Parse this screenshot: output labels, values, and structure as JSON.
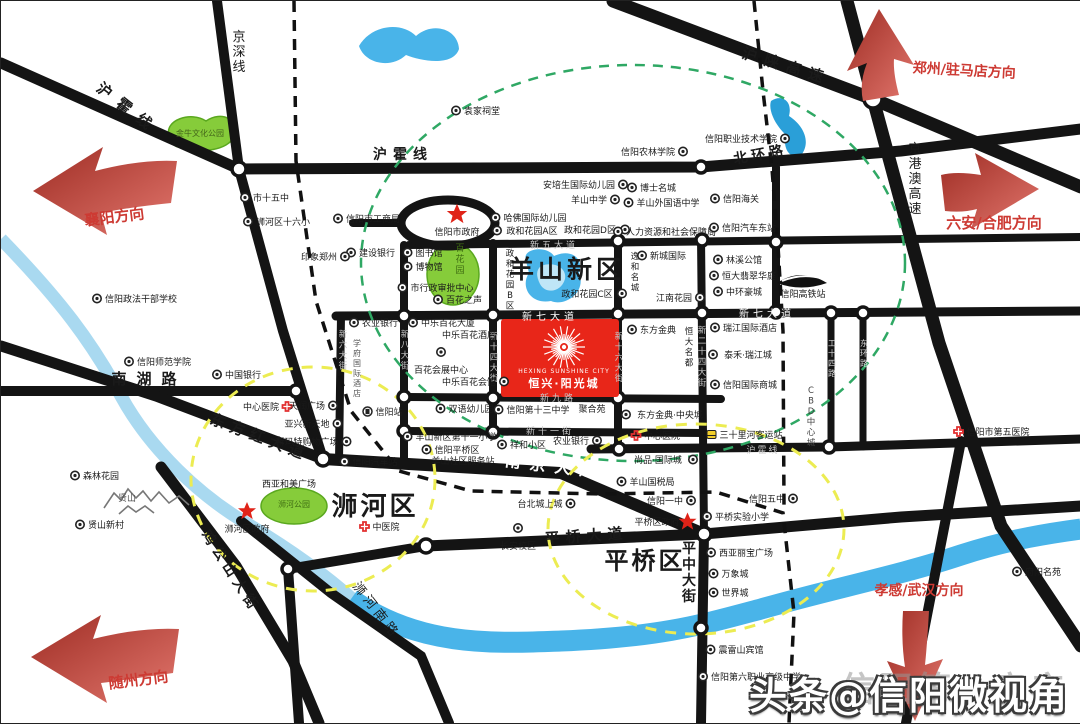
{
  "watermark": {
    "shadow_text": "信阳第一房产",
    "main_text": "头条@信阳微视角"
  },
  "landmark": {
    "en": "HEXING SUNSHINE CITY",
    "cn": "恒兴·阳光城"
  },
  "colors": {
    "road": "#141414",
    "river": "#49b4e9",
    "stream": "#a9d9f0",
    "park": "#86cc3a",
    "landmark_red": "#e82619",
    "direction_red": "#cd3a33",
    "green_ring": "#2fa864",
    "yellow_ring": "#ecec52",
    "star_red": "#e02318",
    "cross_red": "#e23030"
  },
  "labels": [
    {
      "n": "road-huhuo-line-nw",
      "t": "沪霍线",
      "x": 124,
      "y": 112,
      "s": 15,
      "r": 38,
      "ls": 10,
      "b": 1
    },
    {
      "n": "road-jingshen-line",
      "t": "京深线",
      "x": 238,
      "y": 40,
      "s": 13,
      "v": 1
    },
    {
      "n": "road-huhuo-line-n",
      "t": "沪霍线",
      "x": 402,
      "y": 158,
      "s": 14,
      "ls": 6,
      "b": 1
    },
    {
      "n": "road-hushan-expressway",
      "t": "沪陕高速",
      "x": 784,
      "y": 70,
      "s": 15,
      "r": 17,
      "ls": 8,
      "b": 1
    },
    {
      "n": "road-beihuan-road",
      "t": "北环路",
      "x": 760,
      "y": 158,
      "s": 14,
      "r": -10,
      "ls": 4,
      "b": 1
    },
    {
      "n": "road-jinggangao-expressway",
      "t": "京港澳高速",
      "x": 914,
      "y": 152,
      "s": 13,
      "v": 1
    },
    {
      "n": "road-xinwu-avenue",
      "t": "新五大道",
      "x": 553,
      "y": 247,
      "s": 9,
      "c": "#c8c8c8",
      "ls": 3
    },
    {
      "n": "road-xinqi-avenue-west",
      "t": "新七大道",
      "x": 549,
      "y": 319,
      "s": 10,
      "c": "#ffffff",
      "ls": 4
    },
    {
      "n": "road-xinqi-avenue-east",
      "t": "新七大道",
      "x": 766,
      "y": 316,
      "s": 10,
      "c": "#ffffff",
      "ls": 4
    },
    {
      "n": "road-xinjiu-road",
      "t": "新九路",
      "x": 557,
      "y": 400,
      "s": 9,
      "c": "#c8c8c8",
      "ls": 3
    },
    {
      "n": "road-xinshiyi-street",
      "t": "新十一街",
      "x": 549,
      "y": 433,
      "s": 9,
      "c": "#c8c8c8",
      "ls": 3
    },
    {
      "n": "road-nanjing-avenue",
      "t": "南京大道",
      "x": 553,
      "y": 471,
      "s": 16,
      "c": "#ffffff",
      "b": 1,
      "r": 7,
      "ls": 9
    },
    {
      "n": "road-nanhu-road",
      "t": "南湖路",
      "x": 148,
      "y": 383,
      "s": 15,
      "ls": 10,
      "b": 1
    },
    {
      "n": "road-dongfanghong-avenue",
      "t": "东方红大道",
      "x": 257,
      "y": 441,
      "s": 15,
      "r": 21,
      "ls": 6,
      "b": 1
    },
    {
      "n": "road-huhuo-line-east",
      "t": "沪霍线",
      "x": 762,
      "y": 452,
      "s": 9,
      "c": "#c8c8c8",
      "ls": 2
    },
    {
      "n": "road-pingqiao-avenue",
      "t": "平桥大道",
      "x": 586,
      "y": 540,
      "s": 15,
      "r": -4,
      "ls": 6,
      "b": 1
    },
    {
      "n": "road-pingzhong-street",
      "t": "平中大街",
      "x": 688,
      "y": 552,
      "s": 14,
      "v": 1,
      "b": 1
    },
    {
      "n": "road-jigongshan-street",
      "t": "鸡公山大街",
      "x": 226,
      "y": 573,
      "s": 14,
      "r": 57,
      "ls": 5,
      "b": 1
    },
    {
      "n": "road-shihe-south-road",
      "t": "浉河南路",
      "x": 372,
      "y": 612,
      "s": 13,
      "r": 52,
      "ls": 4
    },
    {
      "n": "road-xinliu-street",
      "t": "新六大街",
      "x": 342,
      "y": 336,
      "s": 8.5,
      "v": 1,
      "c": "#c8c8c8"
    },
    {
      "n": "road-xinba-street",
      "t": "新八大街",
      "x": 404,
      "y": 336,
      "s": 8.5,
      "v": 1,
      "c": "#c8c8c8"
    },
    {
      "n": "road-xinshisi-street",
      "t": "新十四大街",
      "x": 493,
      "y": 338,
      "s": 8.5,
      "v": 1,
      "c": "#c8c8c8"
    },
    {
      "n": "road-xinshiliu-street",
      "t": "新十六大街",
      "x": 618,
      "y": 338,
      "s": 8.5,
      "v": 1,
      "c": "#c8c8c8"
    },
    {
      "n": "road-xinershisi-street",
      "t": "新二十四大街",
      "x": 701,
      "y": 332,
      "s": 8.5,
      "v": 1,
      "c": "#c8c8c8"
    },
    {
      "n": "road-gongshisi-road",
      "t": "工十四路",
      "x": 831,
      "y": 345,
      "s": 8,
      "v": 1,
      "c": "#d8d8d8"
    },
    {
      "n": "road-donghuan-road",
      "t": "东环路",
      "x": 863,
      "y": 345,
      "s": 8,
      "v": 1,
      "c": "#d8d8d8"
    },
    {
      "n": "area-cbd-center-city",
      "t": "CBD中心城",
      "x": 810,
      "y": 392,
      "s": 8.5,
      "v": 1,
      "c": "#444444"
    },
    {
      "n": "district-yangshan-new-district",
      "t": "羊山新区",
      "x": 566,
      "y": 277,
      "s": 25,
      "b": 1,
      "ls": 4
    },
    {
      "n": "district-shihe",
      "t": "浉河区",
      "x": 374,
      "y": 514,
      "s": 26,
      "b": 1,
      "ls": 3
    },
    {
      "n": "district-pingqiao",
      "t": "平桥区",
      "x": 644,
      "y": 568,
      "s": 24,
      "b": 1,
      "ls": 3
    },
    {
      "n": "direction-zhengzhou-zhumadian",
      "t": "郑州/驻马店方向",
      "x": 963,
      "y": 74,
      "s": 14,
      "b": 1,
      "c": "#cd3a33",
      "r": 3
    },
    {
      "n": "direction-luan-hefei",
      "t": "六安/合肥方向",
      "x": 993,
      "y": 227,
      "s": 15,
      "b": 1,
      "c": "#cd3a33"
    },
    {
      "n": "direction-xiangyang",
      "t": "襄阳方向",
      "x": 114,
      "y": 221,
      "s": 15,
      "b": 1,
      "c": "#cd3a33",
      "r": -7
    },
    {
      "n": "direction-suizhou",
      "t": "随州方向",
      "x": 138,
      "y": 684,
      "s": 15,
      "b": 1,
      "c": "#cd3a33",
      "r": -7
    },
    {
      "n": "direction-xiaogan-wuhan",
      "t": "孝感/武汉方向",
      "x": 918,
      "y": 594,
      "s": 14,
      "b": 1,
      "c": "#cd3a33"
    },
    {
      "n": "poi-jinniu-culture-park",
      "t": "金牛文化公园",
      "x": 199,
      "y": 135,
      "s": 8,
      "c": "#44661a"
    },
    {
      "n": "poi-no15-middle-school",
      "t": "市十五中",
      "x": 270,
      "y": 200,
      "icon": "ring",
      "ip": "l"
    },
    {
      "n": "poi-shihe-no16-primary",
      "t": "浉河区十六小",
      "x": 282,
      "y": 224,
      "icon": "ring",
      "ip": "l"
    },
    {
      "n": "poi-industry-commerce-bureau",
      "t": "信阳市工商局",
      "x": 372,
      "y": 221,
      "icon": "ring",
      "ip": "l"
    },
    {
      "n": "poi-yuanjia-ancestral-hall",
      "t": "袁家祠堂",
      "x": 481,
      "y": 113,
      "icon": "ring",
      "ip": "l"
    },
    {
      "n": "poi-xinyang-city-government",
      "t": "信阳市政府",
      "x": 456,
      "y": 234,
      "icon": "star",
      "ip": "t",
      "isc": 1.7
    },
    {
      "n": "poi-harvard-kindergarten",
      "t": "哈佛国际幼儿园",
      "x": 534,
      "y": 220,
      "icon": "ring",
      "ip": "l"
    },
    {
      "n": "poi-zhenghe-garden-a",
      "t": "政和花园A区",
      "x": 531,
      "y": 233,
      "icon": "ring",
      "ip": "l"
    },
    {
      "n": "poi-zhenghe-garden-d",
      "t": "政和花园D区",
      "x": 589,
      "y": 232,
      "icon": "ring",
      "ip": "r"
    },
    {
      "n": "poi-anpeisheng-kindergarten",
      "t": "安培生国际幼儿园",
      "x": 578,
      "y": 187,
      "icon": "ring",
      "ip": "r"
    },
    {
      "n": "poi-yangshan-middle-school",
      "t": "羊山中学",
      "x": 588,
      "y": 202,
      "icon": "ring",
      "ip": "r"
    },
    {
      "n": "poi-agriculture-forestry-college",
      "t": "信阳农林学院",
      "x": 647,
      "y": 154,
      "icon": "ring",
      "ip": "r"
    },
    {
      "n": "poi-boshi-mingcheng",
      "t": "博士名城",
      "x": 657,
      "y": 190,
      "icon": "ring",
      "ip": "l"
    },
    {
      "n": "poi-yangshan-foreign-language-school",
      "t": "羊山外国语中学",
      "x": 667,
      "y": 205,
      "icon": "ring",
      "ip": "l"
    },
    {
      "n": "poi-human-resources-bureau",
      "t": "人力资源和社会保障局",
      "x": 670,
      "y": 234,
      "icon": "ring",
      "ip": "l"
    },
    {
      "n": "poi-vocational-technical-college",
      "t": "信阳职业技术学院",
      "x": 740,
      "y": 141,
      "icon": "ring",
      "ip": "r"
    },
    {
      "n": "poi-xinyang-customs",
      "t": "信阳海关",
      "x": 740,
      "y": 201,
      "icon": "ring",
      "ip": "l"
    },
    {
      "n": "poi-east-bus-station",
      "t": "信阳汽车东站",
      "x": 748,
      "y": 230,
      "icon": "ring",
      "ip": "l"
    },
    {
      "n": "poi-construction-bank",
      "t": "建设银行",
      "x": 376,
      "y": 255,
      "icon": "ring",
      "ip": "l"
    },
    {
      "n": "poi-library",
      "t": "图书馆",
      "x": 428,
      "y": 255,
      "icon": "ring",
      "ip": "l"
    },
    {
      "n": "poi-museum",
      "t": "博物馆",
      "x": 428,
      "y": 269,
      "icon": "ring",
      "ip": "l"
    },
    {
      "n": "poi-baihua-garden",
      "t": "百花园",
      "x": 459,
      "y": 250,
      "s": 9,
      "v": 1,
      "c": "#3f6d12"
    },
    {
      "n": "poi-administrative-approval-center",
      "t": "市行政审批中心",
      "x": 441,
      "y": 290,
      "icon": "ring",
      "ip": "l"
    },
    {
      "n": "poi-baihua-zhisheng",
      "t": "百花之声",
      "x": 463,
      "y": 302,
      "icon": "ring",
      "ip": "l"
    },
    {
      "n": "poi-zhenghe-garden-b",
      "t": "政和花园B区",
      "x": 509,
      "y": 255,
      "s": 8.5,
      "v": 1
    },
    {
      "n": "poi-zhenghe-garden-c",
      "t": "政和花园C区",
      "x": 586,
      "y": 296,
      "icon": "ring",
      "ip": "r"
    },
    {
      "n": "poi-xincheng-international",
      "t": "新城国际",
      "x": 667,
      "y": 258,
      "icon": "ring",
      "ip": "l"
    },
    {
      "n": "poi-yihe-mingcheng",
      "t": "逸和名城",
      "x": 634,
      "y": 258,
      "s": 8.5,
      "v": 1
    },
    {
      "n": "poi-jiangnan-garden",
      "t": "江南花园",
      "x": 673,
      "y": 300,
      "icon": "ring",
      "ip": "r"
    },
    {
      "n": "poi-linxi-mansion",
      "t": "林溪公馆",
      "x": 743,
      "y": 262,
      "icon": "ring",
      "ip": "l"
    },
    {
      "n": "poi-hengda-feicui-huating",
      "t": "恒大翡翠华庭",
      "x": 748,
      "y": 278,
      "icon": "ring",
      "ip": "l"
    },
    {
      "n": "poi-zhonghuan-haocheng",
      "t": "中环豪城",
      "x": 743,
      "y": 294,
      "icon": "ring",
      "ip": "l"
    },
    {
      "n": "poi-xinyang-hsr-station",
      "t": "信阳高铁站",
      "x": 802,
      "y": 296
    },
    {
      "n": "poi-agricultural-bank-west",
      "t": "农业银行",
      "x": 379,
      "y": 325,
      "icon": "ring",
      "ip": "l"
    },
    {
      "n": "poi-zhongle-baihua-tower",
      "t": "中乐百花大厦",
      "x": 447,
      "y": 325,
      "icon": "ring",
      "ip": "l"
    },
    {
      "n": "poi-zhongle-baihua-hotel",
      "t": "中乐百花酒店",
      "x": 468,
      "y": 337
    },
    {
      "n": "poi-baihua-exhibition-center",
      "t": "百花会展中心",
      "x": 440,
      "y": 372,
      "icon": "ring",
      "ip": "t"
    },
    {
      "n": "poi-zhongle-baihua-club",
      "t": "中乐百花会馆",
      "x": 468,
      "y": 384,
      "icon": "ring",
      "ip": "r"
    },
    {
      "n": "poi-xuefu-international-hotel",
      "t": "学府国际酒店",
      "x": 356,
      "y": 345,
      "s": 8,
      "v": 1,
      "c": "#555555"
    },
    {
      "n": "poi-dongfang-jindian",
      "t": "东方金典",
      "x": 657,
      "y": 332,
      "icon": "ring",
      "ip": "l"
    },
    {
      "n": "poi-hengda-mingdu",
      "t": "恒大名都",
      "x": 688,
      "y": 333,
      "s": 8.5,
      "v": 1
    },
    {
      "n": "poi-ruijiang-international-hotel",
      "t": "瑞江国际酒店",
      "x": 749,
      "y": 330,
      "icon": "ring",
      "ip": "l"
    },
    {
      "n": "poi-taihe-ruijiang-city",
      "t": "泰禾·瑞江城",
      "x": 747,
      "y": 357,
      "icon": "ring",
      "ip": "l"
    },
    {
      "n": "poi-xinyang-international-mall",
      "t": "信阳国际商城",
      "x": 749,
      "y": 387,
      "icon": "ring",
      "ip": "l"
    },
    {
      "n": "poi-dongfang-jindian-central-city",
      "t": "东方金典·中央城",
      "x": 669,
      "y": 417,
      "icon": "ring",
      "ip": "l"
    },
    {
      "n": "poi-central-hospital-east",
      "t": "中心医院",
      "x": 661,
      "y": 438,
      "icon": "cross",
      "ip": "l"
    },
    {
      "n": "poi-central-hospital-west",
      "t": "中心医院",
      "x": 260,
      "y": 409,
      "icon": "cross",
      "ip": "r"
    },
    {
      "n": "poi-tianrun-plaza",
      "t": "天润广场",
      "x": 306,
      "y": 408,
      "icon": "ring",
      "ip": "r"
    },
    {
      "n": "poi-yaxing-new-world",
      "t": "亚兴新天地",
      "x": 306,
      "y": 426,
      "icon": "ring",
      "ip": "r"
    },
    {
      "n": "poi-xinmate-shopping-plaza",
      "t": "新玛特购物广场",
      "x": 306,
      "y": 444,
      "icon": "ring",
      "ip": "r"
    },
    {
      "n": "poi-yinxiang-zhengzhou",
      "t": "印象郑州",
      "x": 318,
      "y": 259,
      "icon": "ring",
      "ip": "r"
    },
    {
      "n": "poi-political-law-cadre-school",
      "t": "信阳政法干部学校",
      "x": 140,
      "y": 301,
      "icon": "ring",
      "ip": "l"
    },
    {
      "n": "poi-xinyang-normal-college",
      "t": "信阳师范学院",
      "x": 163,
      "y": 364,
      "icon": "ring",
      "ip": "l"
    },
    {
      "n": "poi-bank-of-china",
      "t": "中国银行",
      "x": 242,
      "y": 377,
      "icon": "ring",
      "ip": "l"
    },
    {
      "n": "poi-xinyang-railway-station",
      "t": "信阳站",
      "x": 388,
      "y": 414,
      "icon": "train",
      "ip": "l"
    },
    {
      "n": "poi-bilingual-kindergarten",
      "t": "双语幼儿园",
      "x": 470,
      "y": 411,
      "icon": "ring",
      "ip": "l"
    },
    {
      "n": "poi-no13-middle-school",
      "t": "信阳第十三中学",
      "x": 537,
      "y": 412,
      "icon": "ring",
      "ip": "l"
    },
    {
      "n": "poi-juheyuan",
      "t": "聚合苑",
      "x": 591,
      "y": 411
    },
    {
      "n": "poi-yangshan-no11-primary",
      "t": "羊山新区第十一小学",
      "x": 455,
      "y": 439,
      "icon": "ring",
      "ip": "l"
    },
    {
      "n": "poi-pingqiao-district-line1",
      "t": "信阳平桥区",
      "x": 456,
      "y": 452,
      "icon": "ring",
      "ip": "l"
    },
    {
      "n": "poi-yangshan-community-service",
      "t": "羊山社区服务站",
      "x": 462,
      "y": 463
    },
    {
      "n": "poi-xinyang-bus-station",
      "t": "信阳汽车站",
      "x": 374,
      "y": 464,
      "icon": "ring",
      "ip": "l"
    },
    {
      "n": "poi-xianghe-community",
      "t": "祥和小区",
      "x": 527,
      "y": 447,
      "icon": "ring",
      "ip": "l"
    },
    {
      "n": "poi-agricultural-bank-east",
      "t": "农业银行",
      "x": 570,
      "y": 443,
      "icon": "ring",
      "ip": "r"
    },
    {
      "n": "poi-shangpin-international-city",
      "t": "尚品·国际城",
      "x": 657,
      "y": 462,
      "icon": "ring",
      "ip": "r"
    },
    {
      "n": "poi-sanshilihe-bus-station",
      "t": "三十里河客运站",
      "x": 750,
      "y": 437,
      "icon": "bus",
      "ip": "l"
    },
    {
      "n": "poi-no5-hospital",
      "t": "信阳市第五医院",
      "x": 997,
      "y": 434,
      "icon": "cross",
      "ip": "l"
    },
    {
      "n": "poi-yangshan-tax-bureau",
      "t": "羊山国税局",
      "x": 651,
      "y": 484,
      "icon": "ring",
      "ip": "l"
    },
    {
      "n": "poi-xinyang-no1-high-school",
      "t": "信阳一中",
      "x": 664,
      "y": 503,
      "icon": "ring",
      "ip": "r"
    },
    {
      "n": "poi-pingqiao-district-government",
      "t": "平桥区政府",
      "x": 656,
      "y": 524,
      "icon": "star",
      "ip": "r",
      "isc": 1.5
    },
    {
      "n": "poi-xinyang-no5-high-school",
      "t": "信阳五中",
      "x": 766,
      "y": 501,
      "icon": "ring",
      "ip": "r"
    },
    {
      "n": "poi-pingqiao-experimental-primary",
      "t": "平桥实验小学",
      "x": 741,
      "y": 519,
      "icon": "ring",
      "ip": "l"
    },
    {
      "n": "poi-taibeicheng-shangcheng",
      "t": "台北城上城",
      "x": 539,
      "y": 506,
      "icon": "ring",
      "ip": "r"
    },
    {
      "n": "poi-changan-campus",
      "t": "长安校区",
      "x": 517,
      "y": 548,
      "icon": "ring",
      "ip": "t"
    },
    {
      "n": "poi-traditional-chinese-hospital",
      "t": "中医院",
      "x": 385,
      "y": 529,
      "icon": "cross",
      "ip": "l"
    },
    {
      "n": "poi-xiya-hemei-plaza",
      "t": "西亚和美广场",
      "x": 288,
      "y": 486
    },
    {
      "n": "poi-shihe-park",
      "t": "浉河公园",
      "x": 293,
      "y": 506,
      "s": 8,
      "c": "#3f6d12"
    },
    {
      "n": "poi-shihe-district-government",
      "t": "浉河区政府",
      "x": 246,
      "y": 531,
      "icon": "star",
      "ip": "t",
      "isc": 1.5
    },
    {
      "n": "poi-xianshan-mountain",
      "t": "贤山",
      "x": 126,
      "y": 500,
      "c": "#555555"
    },
    {
      "n": "poi-xianshan-new-village",
      "t": "贤山新村",
      "x": 105,
      "y": 527,
      "icon": "ring",
      "ip": "l"
    },
    {
      "n": "poi-forest-garden",
      "t": "森林花园",
      "x": 100,
      "y": 478,
      "icon": "ring",
      "ip": "l"
    },
    {
      "n": "poi-xiya-libao-plaza",
      "t": "西亚丽宝广场",
      "x": 745,
      "y": 555,
      "icon": "ring",
      "ip": "l"
    },
    {
      "n": "poi-wanxiangcheng",
      "t": "万象城",
      "x": 734,
      "y": 576,
      "icon": "ring",
      "ip": "l"
    },
    {
      "n": "poi-shijiecheng",
      "t": "世界城",
      "x": 734,
      "y": 595,
      "icon": "ring",
      "ip": "l"
    },
    {
      "n": "poi-zhenleishan-hotel",
      "t": "震雷山宾馆",
      "x": 740,
      "y": 652,
      "icon": "ring",
      "ip": "l"
    },
    {
      "n": "poi-no6-vocational-high-school",
      "t": "信阳第六职业高级中学",
      "x": 755,
      "y": 679,
      "icon": "ring",
      "ip": "l"
    },
    {
      "n": "poi-fuyang-mingyuan",
      "t": "府阳名苑",
      "x": 1042,
      "y": 574,
      "icon": "ring",
      "ip": "l"
    }
  ]
}
